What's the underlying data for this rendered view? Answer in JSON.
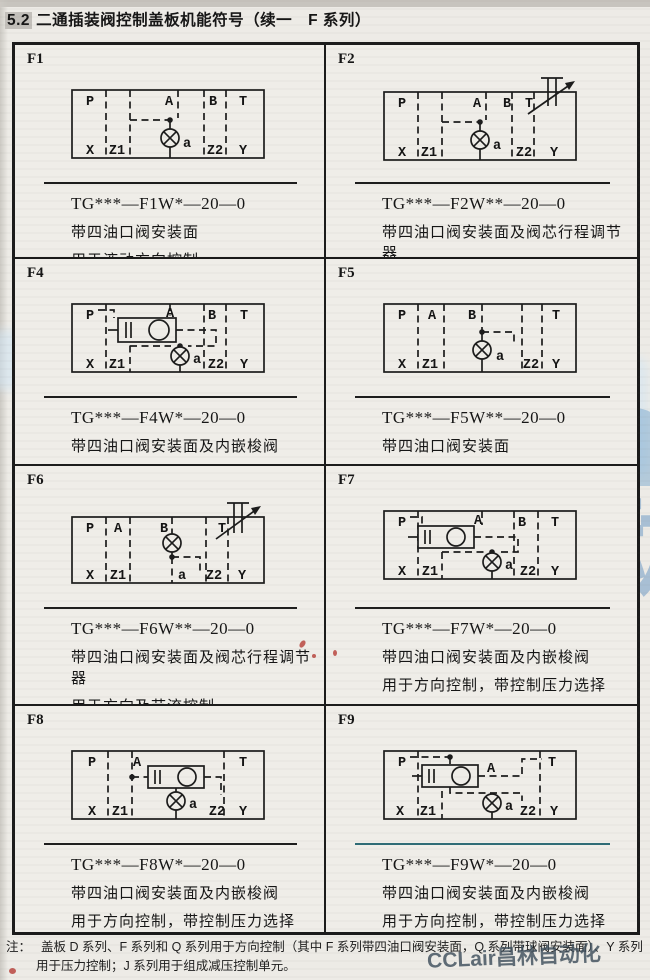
{
  "page": {
    "section_number": "5.2",
    "title_text": "二通插装阀控制盖板机能符号（续一　F 系列）",
    "note": {
      "label": "注：",
      "line1": "盖板 D 系列、F 系列和 Q 系列用于方向控制（其中 F 系列带四油口阀安装面，Q 系列带球阀安装面）、Y 系列",
      "line2": "用于压力控制；J 系列用于组成减压控制单元。"
    },
    "watermarks": {
      "large_latin": "CCLair",
      "large_cn": "昌林自动化",
      "corner": "CCLair昌林自动化",
      "color": "#5b9bd5"
    }
  },
  "cells": [
    {
      "id": "F1",
      "model": "TG***—F1W*—20—0",
      "desc1": "带四油口阀安装面",
      "desc2": "用于液动方向控制",
      "labels": {
        "P": "P",
        "A": "A",
        "B": "B",
        "T": "T",
        "X": "X",
        "Z1": "Z1",
        "a": "a",
        "Z2": "Z2",
        "Y": "Y"
      }
    },
    {
      "id": "F2",
      "model": "TG***—F2W**—20—0",
      "desc1": "带四油口阀安装面及阀芯行程调节器",
      "desc2": "用于方向及节流控制",
      "labels": {
        "P": "P",
        "A": "A",
        "B": "B",
        "T": "T",
        "X": "X",
        "Z1": "Z1",
        "a": "a",
        "Z2": "Z2",
        "Y": "Y"
      }
    },
    {
      "id": "F4",
      "model": "TG***—F4W*—20—0",
      "desc1": "带四油口阀安装面及内嵌梭阀",
      "desc2": "用于方向控制，带控制压力选择",
      "labels": {
        "P": "P",
        "A": "A",
        "B": "B",
        "T": "T",
        "X": "X",
        "Z1": "Z1",
        "a": "a",
        "Z2": "Z2",
        "Y": "Y"
      }
    },
    {
      "id": "F5",
      "model": "TG***—F5W**—20—0",
      "desc1": "带四油口阀安装面",
      "desc2": "用于方向控制",
      "labels": {
        "P": "P",
        "A": "A",
        "B": "B",
        "T": "T",
        "X": "X",
        "Z1": "Z1",
        "a": "a",
        "Z2": "Z2",
        "Y": "Y"
      }
    },
    {
      "id": "F6",
      "model": "TG***—F6W**—20—0",
      "desc1": "带四油口阀安装面及阀芯行程调节器",
      "desc2": "用于方向及节流控制",
      "labels": {
        "P": "P",
        "A": "A",
        "B": "B",
        "T": "T",
        "X": "X",
        "Z1": "Z1",
        "a": "a",
        "Z2": "Z2",
        "Y": "Y"
      }
    },
    {
      "id": "F7",
      "model": "TG***—F7W*—20—0",
      "desc1": "带四油口阀安装面及内嵌梭阀",
      "desc2": "用于方向控制，带控制压力选择",
      "labels": {
        "P": "P",
        "A": "A",
        "B": "B",
        "T": "T",
        "X": "X",
        "Z1": "Z1",
        "a": "a",
        "Z2": "Z2",
        "Y": "Y"
      }
    },
    {
      "id": "F8",
      "model": "TG***—F8W*—20—0",
      "desc1": "带四油口阀安装面及内嵌梭阀",
      "desc2": "用于方向控制，带控制压力选择",
      "labels": {
        "P": "P",
        "A": "A",
        "T": "T",
        "X": "X",
        "Z1": "Z1",
        "a": "a",
        "Z2": "Z2",
        "Y": "Y"
      }
    },
    {
      "id": "F9",
      "model": "TG***—F9W*—20—0",
      "desc1": "带四油口阀安装面及内嵌梭阀",
      "desc2": "用于方向控制，带控制压力选择",
      "labels": {
        "P": "P",
        "A": "A",
        "T": "T",
        "X": "X",
        "Z1": "Z1",
        "a": "a",
        "Z2": "Z2",
        "Y": "Y"
      }
    }
  ]
}
